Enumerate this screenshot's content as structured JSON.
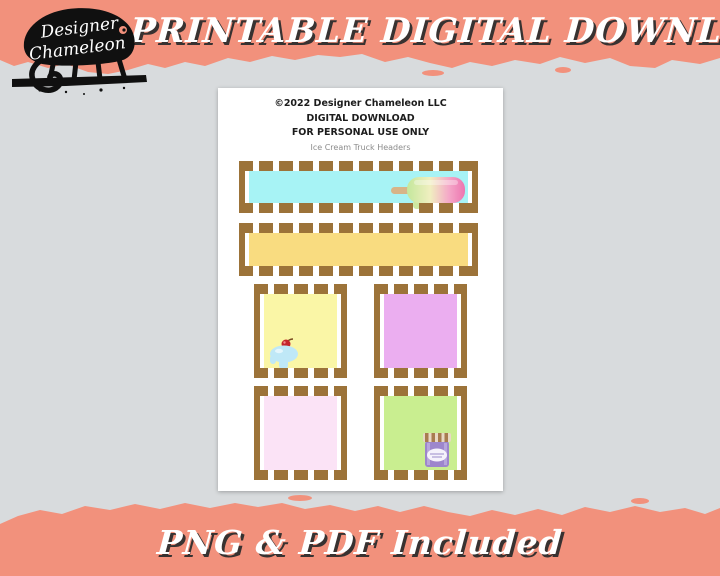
{
  "background_color": "#D8DBDD",
  "top_banner": {
    "title": "PRINTABLE DIGITAL DOWNLOAD",
    "bg_color": "#F2917C",
    "text_color": "#FFFFFF"
  },
  "bottom_banner": {
    "title": "PNG & PDF Included",
    "bg_color": "#F2917C",
    "text_color": "#FFFFFF"
  },
  "logo": {
    "name_line1": "Designer",
    "name_line2": "Chameleon"
  },
  "page": {
    "copyright_line": "©2022 Designer Chameleon LLC",
    "usage_line1": "DIGITAL DOWNLOAD",
    "usage_line2": "FOR PERSONAL USE ONLY",
    "product_title": "Ice Cream Truck Headers",
    "frame_color": "#9C7339",
    "items": [
      {
        "name": "header-banner-cyan",
        "fill": "#A7F3F5",
        "decoration": "popsicle"
      },
      {
        "name": "header-banner-gold",
        "fill": "#F9DC80",
        "decoration": ""
      },
      {
        "name": "square-pale-yellow",
        "fill": "#FAF6A6",
        "decoration": "ice-cream-sundae"
      },
      {
        "name": "square-lavender",
        "fill": "#EBAEF0",
        "decoration": ""
      },
      {
        "name": "square-pale-pink",
        "fill": "#FBE3F6",
        "decoration": ""
      },
      {
        "name": "square-light-green",
        "fill": "#C9EE90",
        "decoration": "ice-cream-tub"
      }
    ]
  }
}
